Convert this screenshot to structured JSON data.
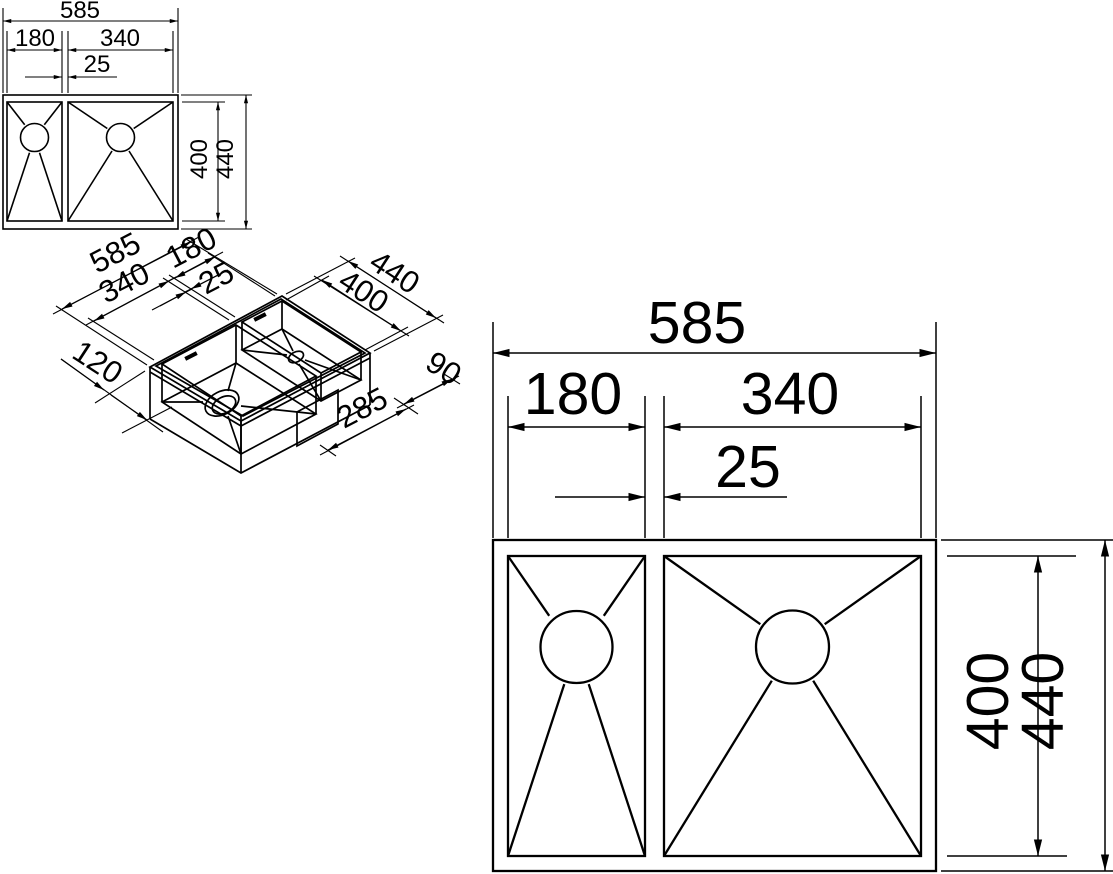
{
  "drawing": {
    "subject": "double-bowl sink technical drawing",
    "style": {
      "line_color": "#000000",
      "background": "#ffffff"
    }
  },
  "views": {
    "top_small": {
      "name": "top view (small)",
      "dims": {
        "total_width": "585",
        "left_bowl_width": "180",
        "right_bowl_width": "340",
        "divider_width": "25",
        "bowl_depth": "400",
        "total_depth": "440"
      }
    },
    "isometric": {
      "name": "isometric view",
      "dims": {
        "total_width": "585",
        "front_bowl_width": "340",
        "back_bowl_width": "180",
        "divider_width": "25",
        "total_depth": "440",
        "bowl_depth": "400",
        "drain_offset": "120",
        "clip_width": "90",
        "clip_offset": "285"
      }
    },
    "top_large": {
      "name": "top view (large)",
      "dims": {
        "total_width": "585",
        "left_bowl_width": "180",
        "right_bowl_width": "340",
        "divider_width": "25",
        "bowl_depth": "400",
        "total_depth": "440"
      }
    }
  }
}
